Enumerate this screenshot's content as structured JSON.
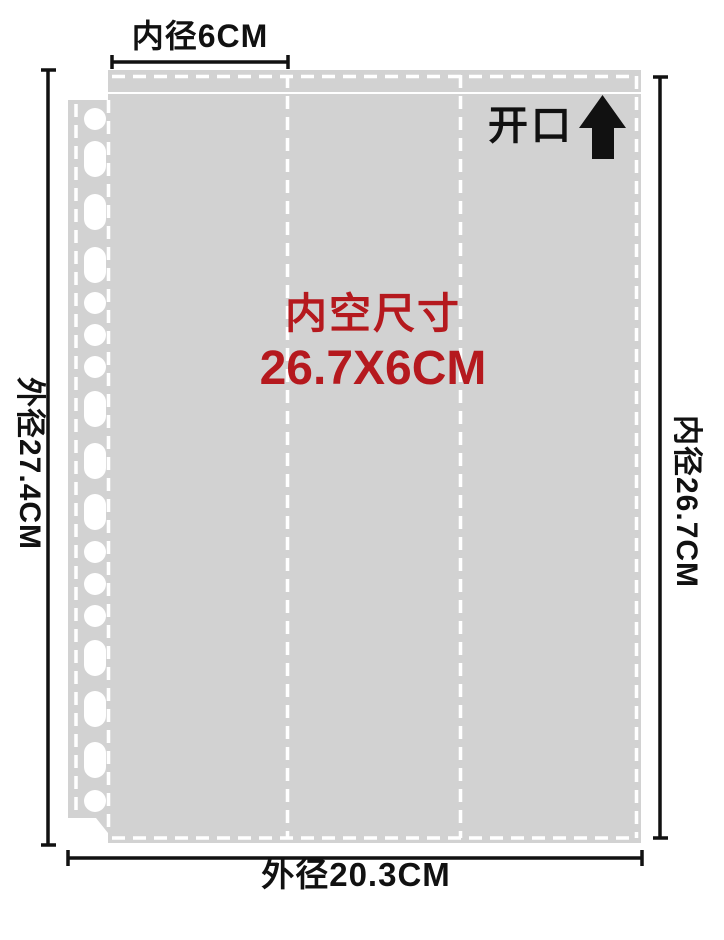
{
  "diagram": {
    "type": "product-dimension-diagram",
    "subject": "punched sheet protector pocket page",
    "labels": {
      "top_inner_width": "内径6CM",
      "left_outer_height": "外径27.4CM",
      "right_inner_height": "内径26.7CM",
      "bottom_outer_width": "外径20.3CM",
      "opening": "开口",
      "inner_size_title": "内空尺寸",
      "inner_size_value": "26.7X6CM"
    },
    "icons": {
      "opening_arrow": "up-arrow-icon"
    },
    "colors": {
      "background": "#ffffff",
      "sheet_fill": "#d2d2d2",
      "stitch_lines": "#ffffff",
      "dimension_lines": "#111111",
      "inner_size_text": "#b5191e",
      "arrow": "#111111"
    },
    "structure": {
      "pocket_columns": 3,
      "punch_holes": 17,
      "opening_side": "top"
    }
  }
}
